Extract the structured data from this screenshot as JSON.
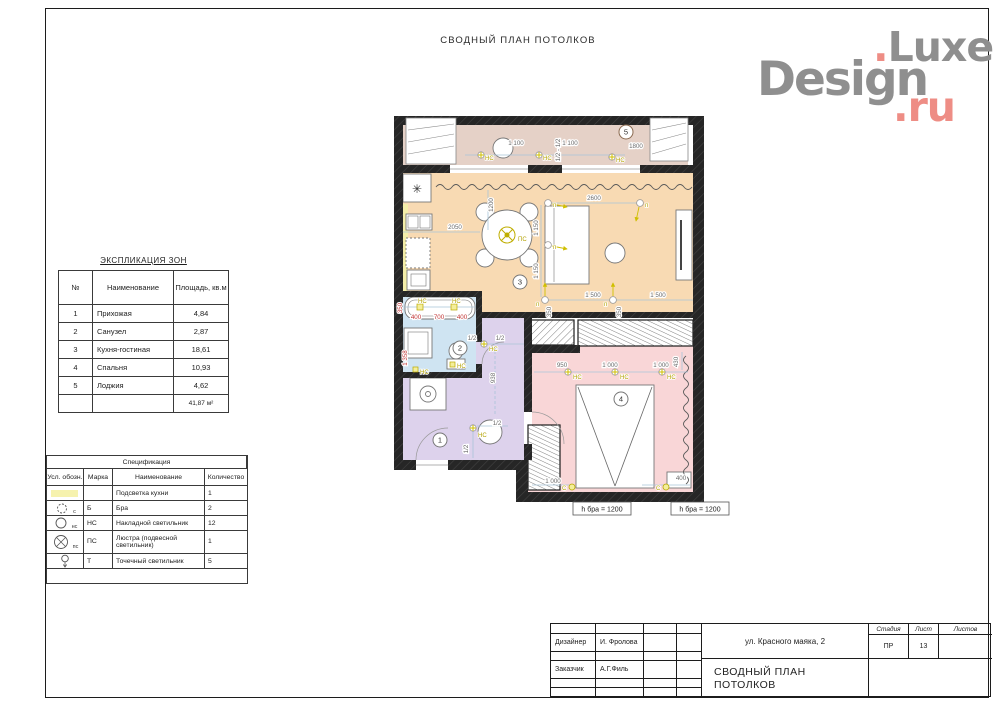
{
  "page": {
    "title": "СВОДНЫЙ ПЛАН ПОТОЛКОВ"
  },
  "logo": {
    "luxe": "Luxe",
    "design": "Design",
    "ru": "ru",
    "dot": ".",
    "gray": "#8f8f8f",
    "pink": "#ee8d85"
  },
  "explication": {
    "title": "ЭКСПЛИКАЦИЯ ЗОН",
    "headers": [
      "№",
      "Наименование",
      "Площадь, кв.м"
    ],
    "rows": [
      [
        "1",
        "Прихожая",
        "4,84"
      ],
      [
        "2",
        "Санузел",
        "2,87"
      ],
      [
        "3",
        "Кухня-гостиная",
        "18,61"
      ],
      [
        "4",
        "Спальня",
        "10,93"
      ],
      [
        "5",
        "Лоджия",
        "4,62"
      ]
    ],
    "total": "41,87 м²"
  },
  "specification": {
    "title": "Спецификация",
    "headers": [
      "Усл. обозн.",
      "Марка",
      "Наименование",
      "Количество"
    ],
    "rows": [
      {
        "symbol": "kitchen-backlight",
        "symbol_label": "",
        "mark": "",
        "name": "Подсветка кухни",
        "qty": "1"
      },
      {
        "symbol": "sconce",
        "symbol_label": "с",
        "mark": "Б",
        "name": "Бра",
        "qty": "2"
      },
      {
        "symbol": "surface-light",
        "symbol_label": "нс",
        "mark": "НС",
        "name": "Накладной светильник",
        "qty": "12"
      },
      {
        "symbol": "chandelier",
        "symbol_label": "пс",
        "mark": "ПС",
        "name": "Люстра (подвесной светильник)",
        "qty": "1"
      },
      {
        "symbol": "spot-light",
        "symbol_label": "",
        "mark": "Т",
        "name": "Точечный светильник",
        "qty": "5"
      }
    ]
  },
  "title_block": {
    "designer_label": "Дизайнер",
    "designer_name": "И. Фролова",
    "client_label": "Заказчик",
    "client_name": "А.Г.Филь",
    "address": "ул. Красного маяка, 2",
    "drawing_title": "СВОДНЫЙ ПЛАН ПОТОЛКОВ",
    "stage_label": "Стадия",
    "sheet_label": "Лист",
    "sheets_label": "Листов",
    "stage": "ПР",
    "sheet": "13",
    "sheets": ""
  },
  "icons": {
    "snowflake": "✳"
  },
  "plan": {
    "zone_circles": [
      "1",
      "2",
      "3",
      "4",
      "5"
    ],
    "gray_dims": [
      "1 100",
      "1 100",
      "1800",
      "1/2 - 1/2",
      "2600",
      "1200",
      "2050",
      "1 150",
      "1 150",
      "1 500",
      "1 500",
      "350",
      "350",
      "1/2",
      "1/2",
      "938",
      "1/2",
      "1/2",
      "950",
      "1 000",
      "1 000",
      "430",
      "1 000",
      "400"
    ],
    "red_dims": [
      "350",
      "400",
      "700",
      "400",
      "1 358"
    ],
    "yellow_marks": [
      "НС",
      "НС",
      "НС",
      "п",
      "п",
      "п",
      "ПС",
      "п",
      "п",
      "НС",
      "НС",
      "НС",
      "НС",
      "НС",
      "НС",
      "НС",
      "НС",
      "НС",
      "С",
      "С"
    ],
    "notes": [
      "h бра = 1200",
      "h бра = 1200"
    ],
    "colors": {
      "loggia": "#e5d1c7",
      "living": "#f8dab3",
      "bath": "#cfe4f2",
      "hall": "#ddd2ec",
      "bedroom": "#f9d6d7",
      "backlight": "#f3eda9",
      "marks": "#b3a200",
      "red_dim": "#c13434"
    }
  }
}
